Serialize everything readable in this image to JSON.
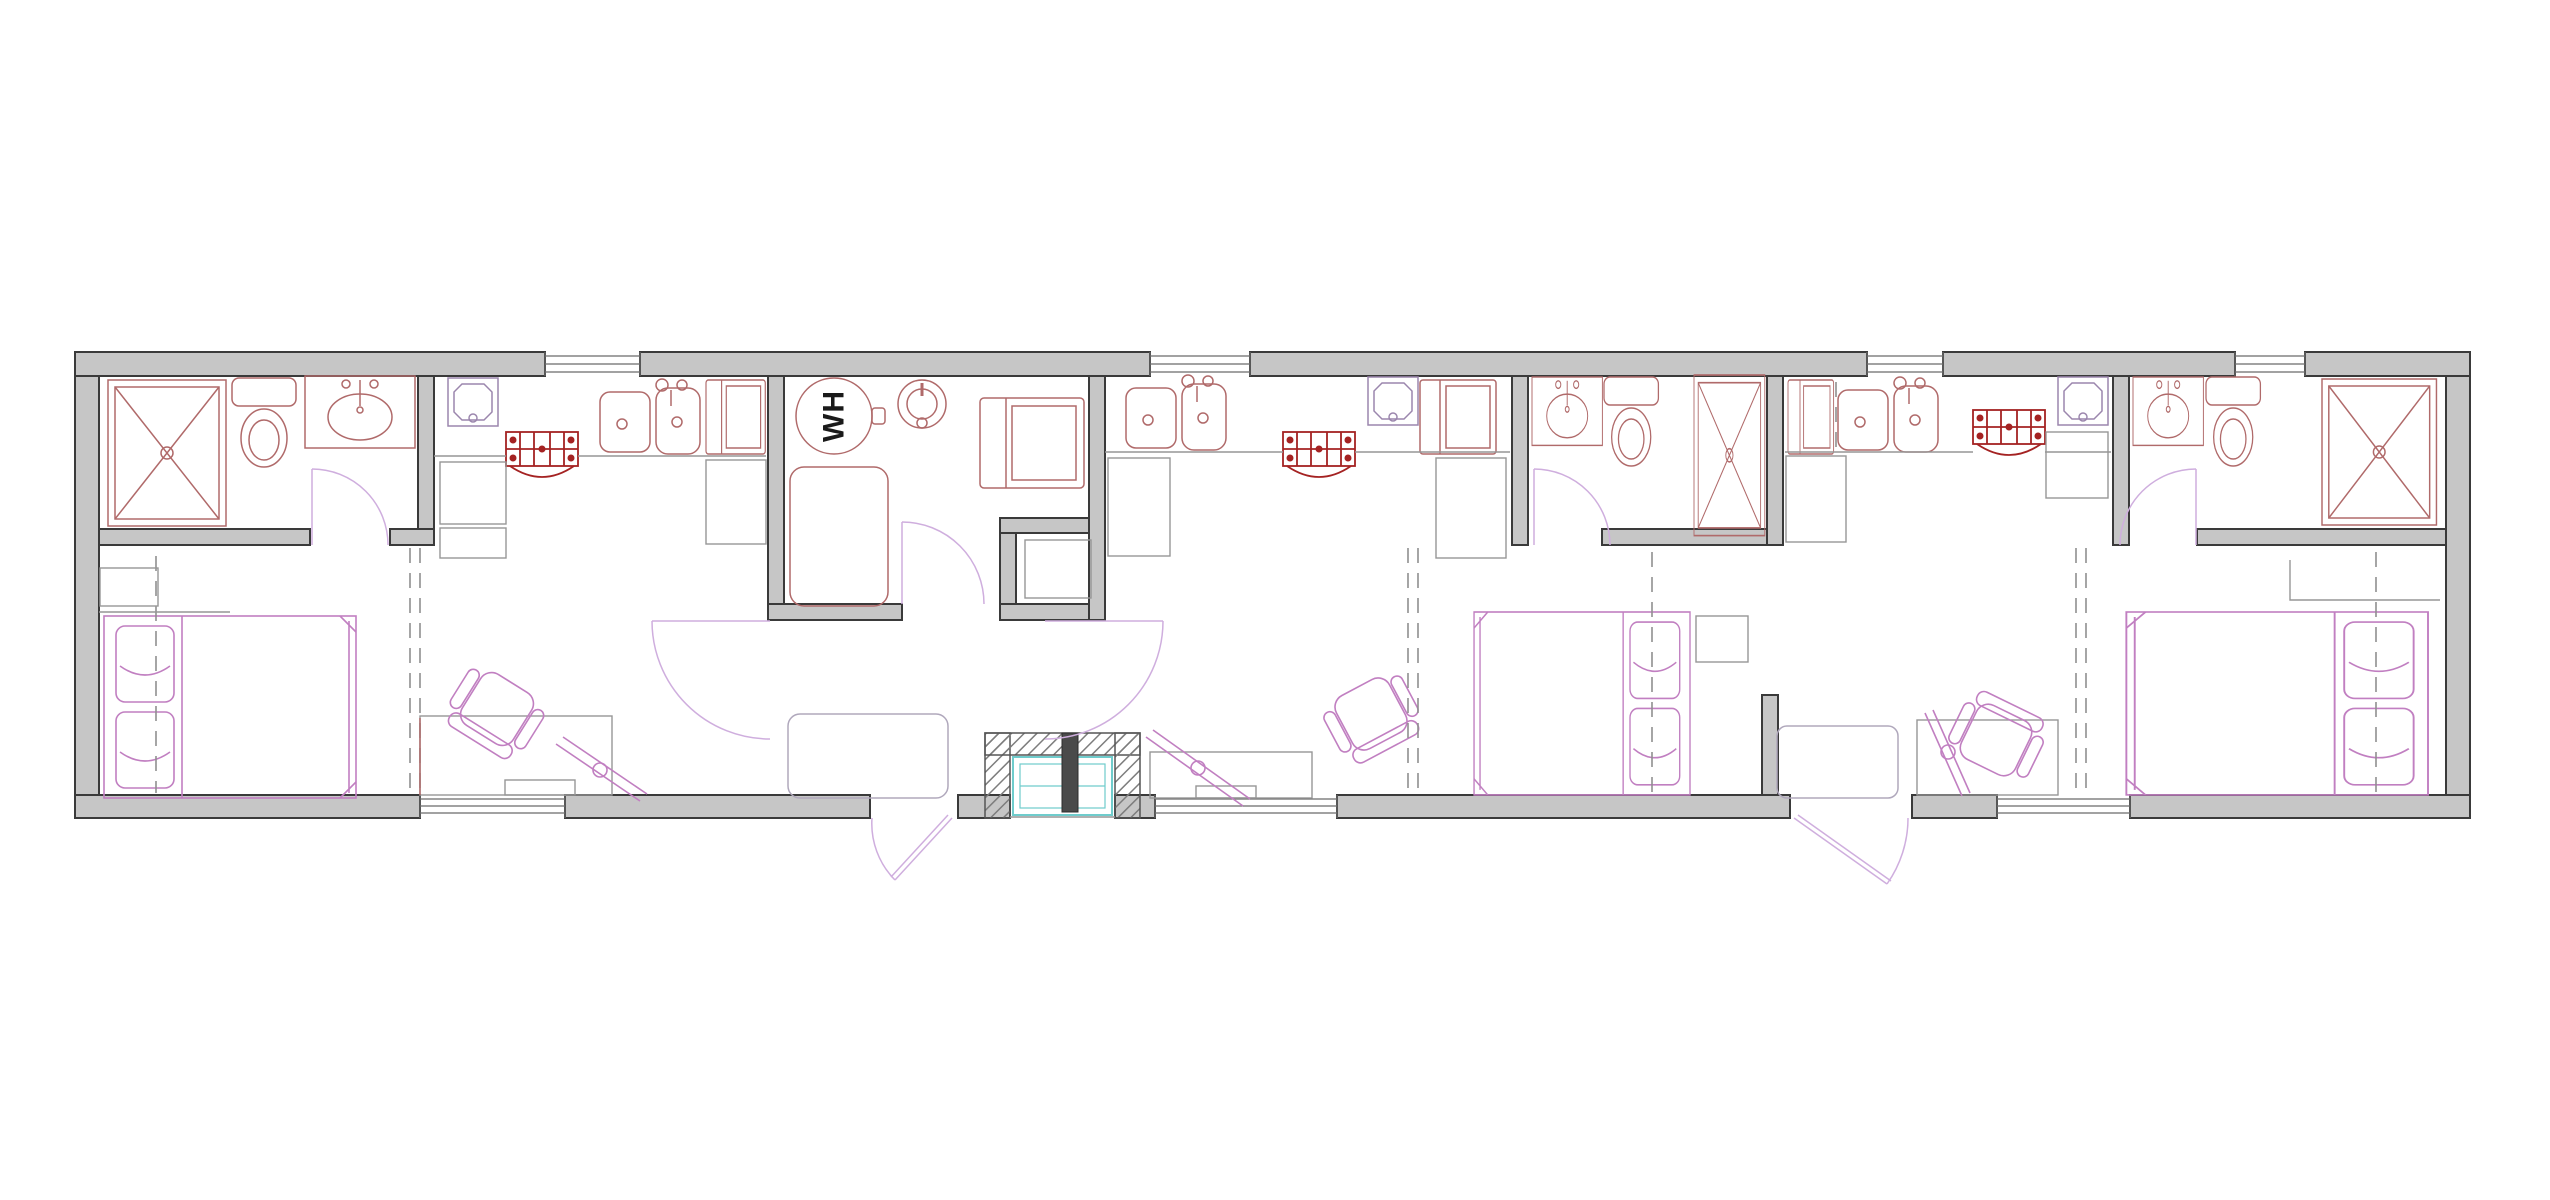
{
  "drawing": {
    "kind": "architectural-floor-plan",
    "view": "plan",
    "background": "#ffffff"
  },
  "labels": {
    "water_heater": "WH"
  },
  "palette": {
    "wall_fill": "#c6c6c6",
    "wall_edge": "#3a3a3a",
    "fixture_red": "#b06a6a",
    "stove_red": "#a42222",
    "appliance_purple": "#9b86ad",
    "furniture_magenta": "#c17fc1",
    "door_swing": "#cfaede",
    "construction_gray": "#969696",
    "hvac_teal": "#6fcccc",
    "label_text": "#1a1a1a"
  },
  "units": [
    {
      "id": "unit-a",
      "rooms": [
        "bathroom",
        "kitchen",
        "bedroom",
        "living-area"
      ],
      "fixtures": [
        "shower",
        "toilet",
        "vanity-sink",
        "kitchen-sink",
        "range",
        "dishwasher",
        "refrigerator",
        "base-cabinets",
        "bed",
        "pillows",
        "nightstand",
        "closet",
        "desk",
        "office-chair",
        "tv",
        "bench"
      ]
    },
    {
      "id": "utility-core",
      "rooms": [
        "water-heater-room",
        "storage-closet",
        "entry-porch"
      ],
      "fixtures": [
        "water-heater",
        "expansion-tank",
        "equipment-platform",
        "washer-dryer",
        "storage-shelf",
        "hvac-unit"
      ]
    },
    {
      "id": "unit-b",
      "rooms": [
        "kitchen",
        "bathroom",
        "bedroom",
        "living-area"
      ],
      "fixtures": [
        "kitchen-sink",
        "range",
        "dishwasher",
        "refrigerator",
        "vanity-sink",
        "toilet",
        "shower",
        "bed",
        "pillows",
        "nightstand",
        "closet",
        "desk",
        "office-chair",
        "tv"
      ]
    },
    {
      "id": "unit-c",
      "rooms": [
        "kitchen",
        "bathroom",
        "bedroom",
        "living-area"
      ],
      "fixtures": [
        "refrigerator",
        "kitchen-sink",
        "range",
        "dishwasher",
        "vanity-sink",
        "toilet",
        "shower",
        "bed",
        "pillows",
        "closet-shelf",
        "desk",
        "office-chair",
        "tv",
        "bench"
      ]
    }
  ],
  "openings": {
    "top_windows": 4,
    "bottom_windows": 3,
    "exterior_doors": 2,
    "interior_door_swings": 6,
    "recessed_entry_porch": 1
  }
}
